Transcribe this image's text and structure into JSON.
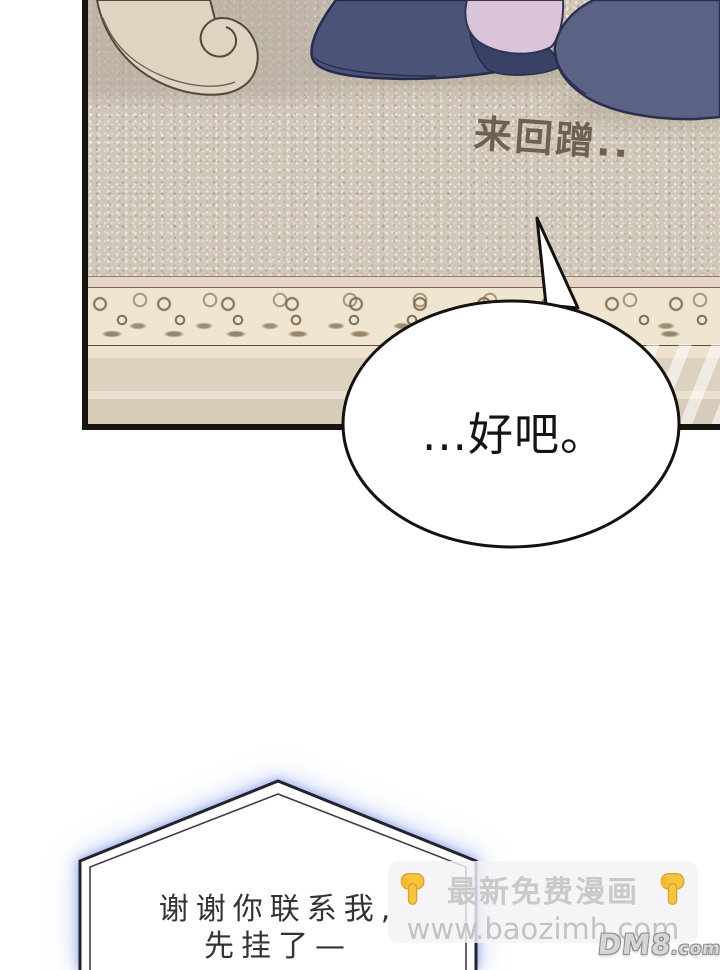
{
  "panel1": {
    "sfx": "来回蹭..",
    "speech": "...好吧。"
  },
  "panel2": {
    "speech_line1": "谢谢你联系我,",
    "speech_line2": "先挂了—"
  },
  "watermark": {
    "title": "最新免费漫画",
    "url": "www.baozimh.com",
    "logo_main": "DM8",
    "logo_suffix": ".com"
  },
  "colors": {
    "carpet": "#d0c7b9",
    "carpet_border_scroll": "#7a6448",
    "slipper_navy": "#4b5378",
    "slipper_navy_light": "#5b6384",
    "pant_lavender": "#d9c4da",
    "bubble_outline": "#17140f",
    "bubble2_glow": "#a8b6e8",
    "watermark_text": "#c4c4c4",
    "hand_yellow": "#f7c53d"
  }
}
